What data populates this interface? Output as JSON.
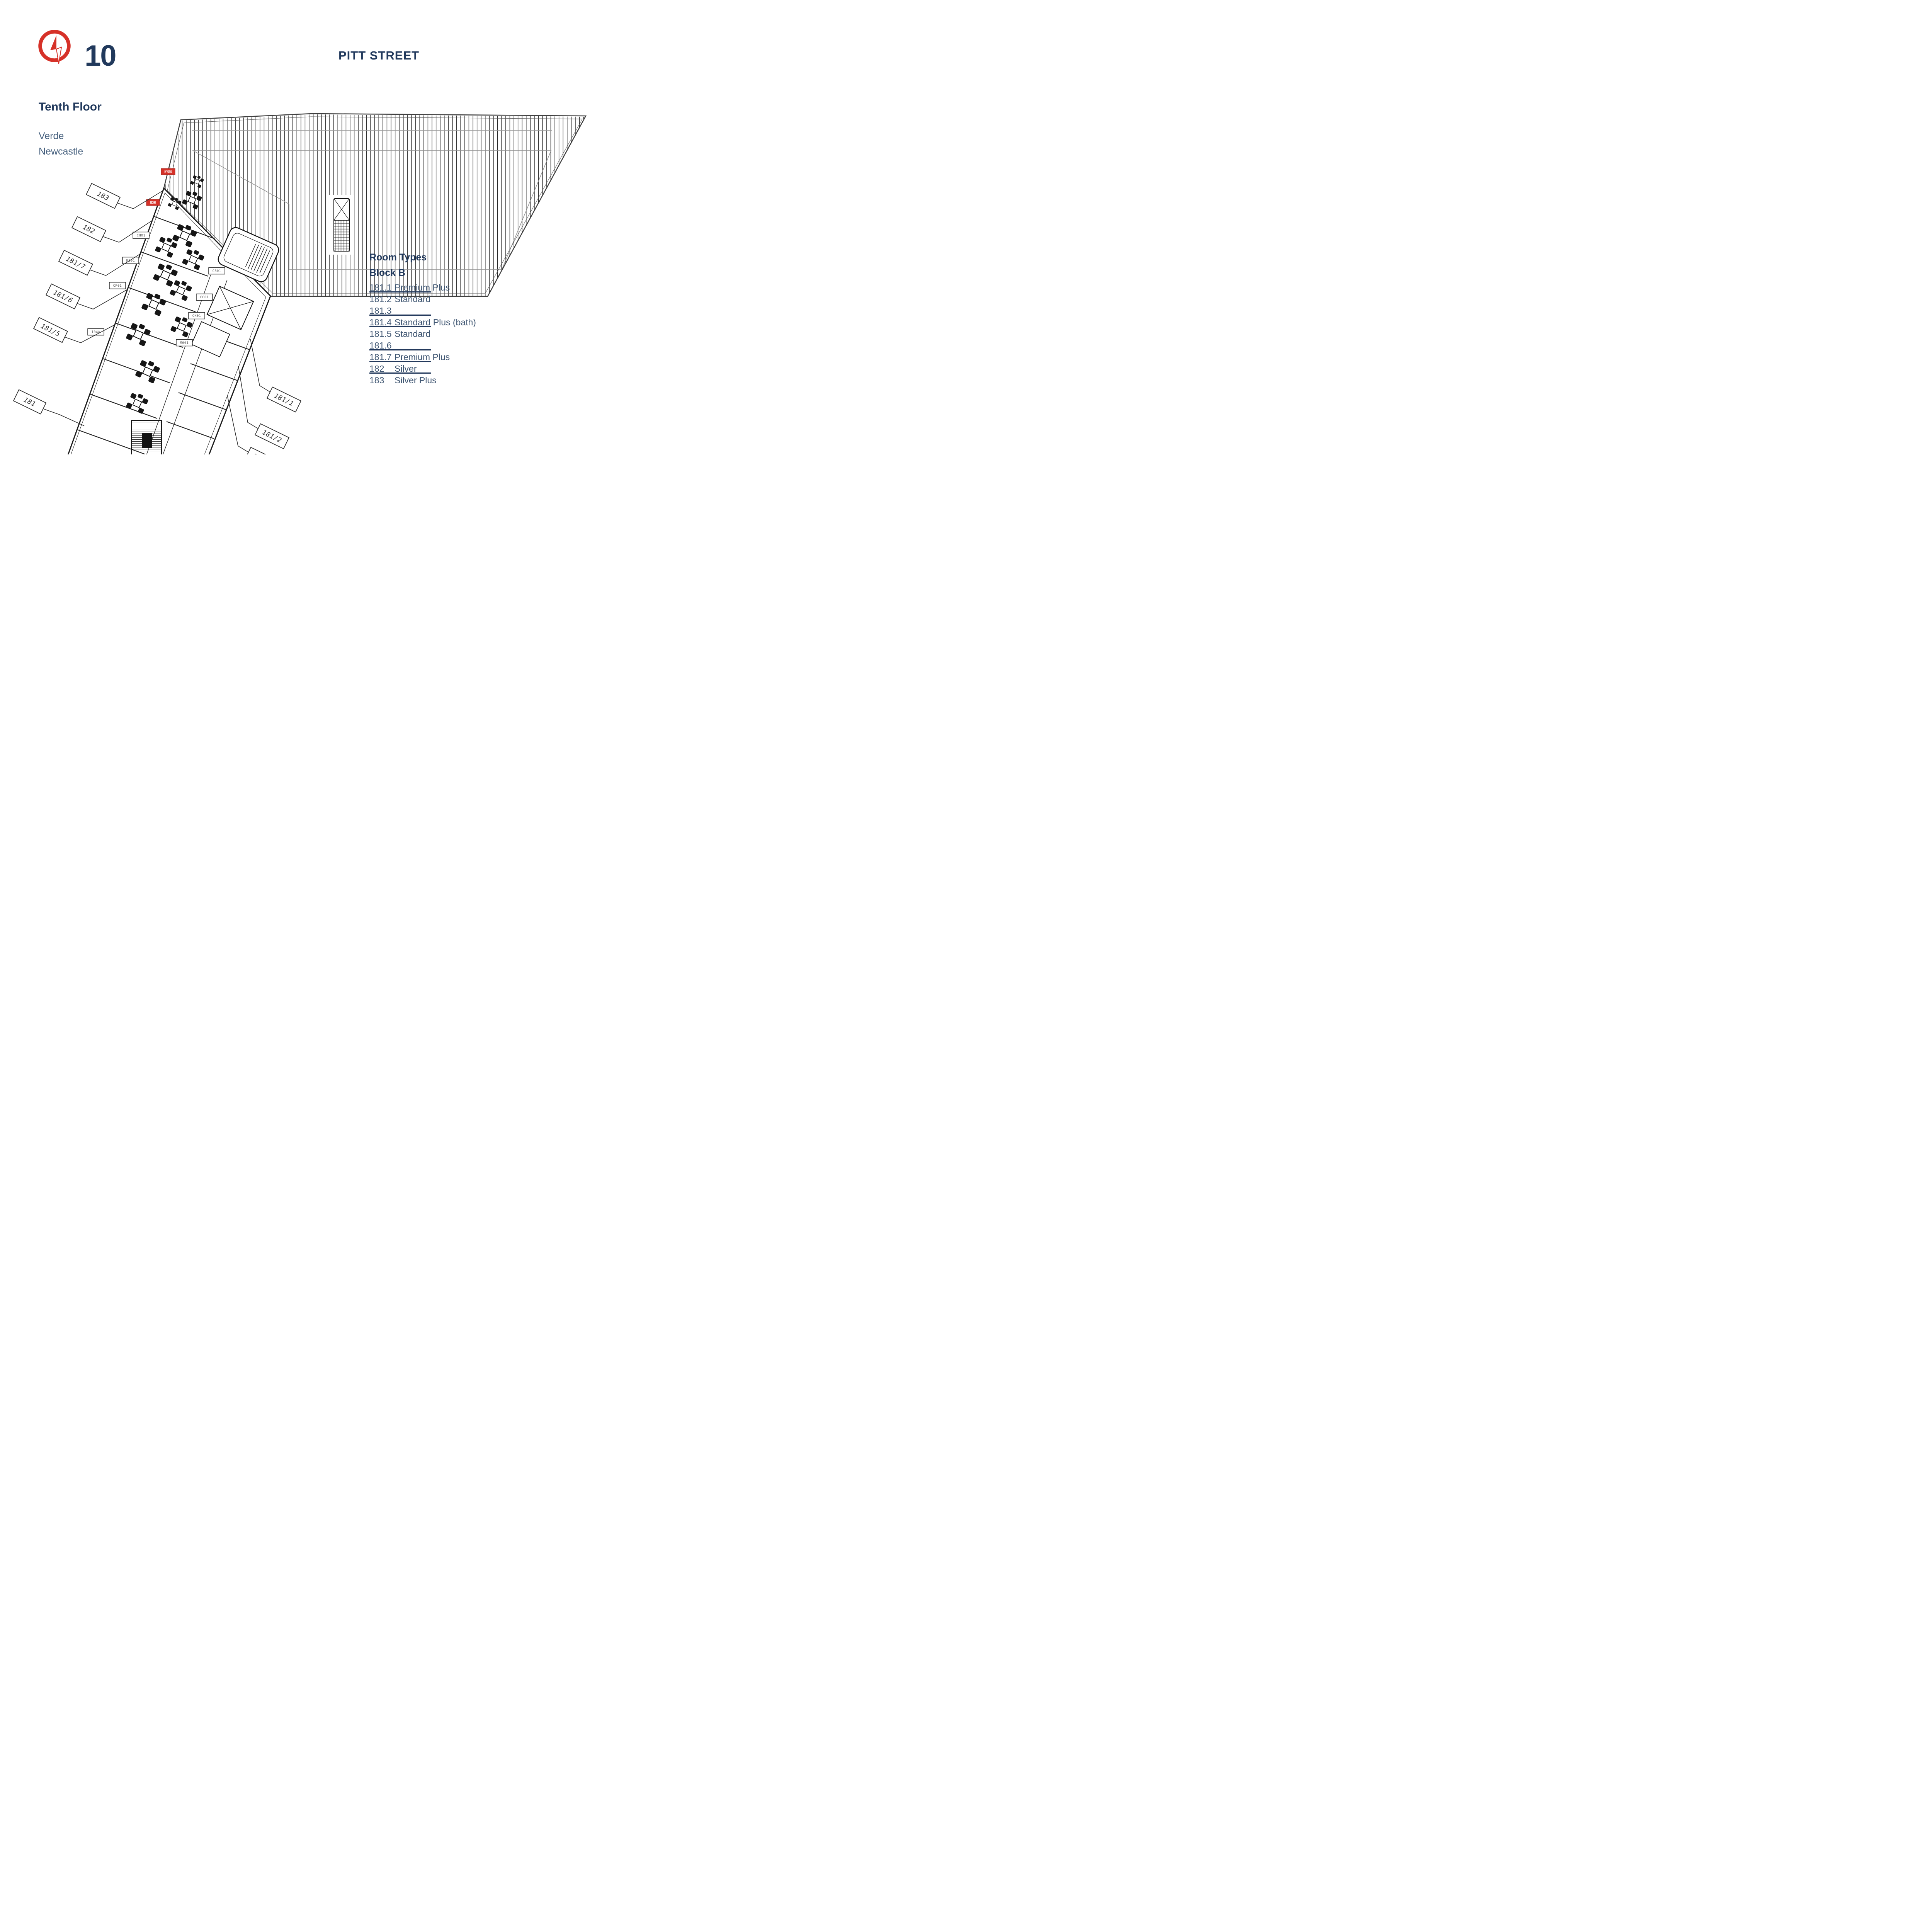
{
  "header": {
    "floor_number": "10",
    "floor_name": "Tenth Floor",
    "development": "Verde",
    "city": "Newcastle",
    "street_label": "PITT STREET"
  },
  "legend": {
    "title": "Room Types",
    "subtitle": "Block B",
    "rows": [
      {
        "number": "181.1",
        "type": "Premium Plus",
        "underlined": true
      },
      {
        "number": "181.2",
        "type": "Standard",
        "underlined": false
      },
      {
        "number": "181.3",
        "type": "",
        "underlined": true
      },
      {
        "number": "181.4",
        "type": "Standard Plus (bath)",
        "underlined": true
      },
      {
        "number": "181.5",
        "type": "Standard",
        "underlined": false
      },
      {
        "number": "181.6",
        "type": "",
        "underlined": true
      },
      {
        "number": "181.7",
        "type": "Premium Plus",
        "underlined": true
      },
      {
        "number": "182",
        "type": "Silver",
        "underlined": true
      },
      {
        "number": "183",
        "type": "Silver Plus",
        "underlined": false
      }
    ]
  },
  "plan": {
    "unit_labels": [
      "183",
      "182",
      "181/7",
      "181/6",
      "181/5",
      "181",
      "181/1",
      "181/2",
      "181/3",
      "181/4"
    ],
    "room_tags": [
      "CH01",
      "K001",
      "CP01",
      "C801",
      "CC01",
      "CK01",
      "104A",
      "M001"
    ],
    "red_tags": [
      "HY5G",
      "B3H"
    ]
  },
  "icons": {
    "compass": "compass-icon"
  },
  "colors": {
    "navy": "#21395C",
    "slate": "#3E5571",
    "red": "#D63128",
    "plan_line": "#1A1A1A",
    "gray_line": "#999999"
  }
}
